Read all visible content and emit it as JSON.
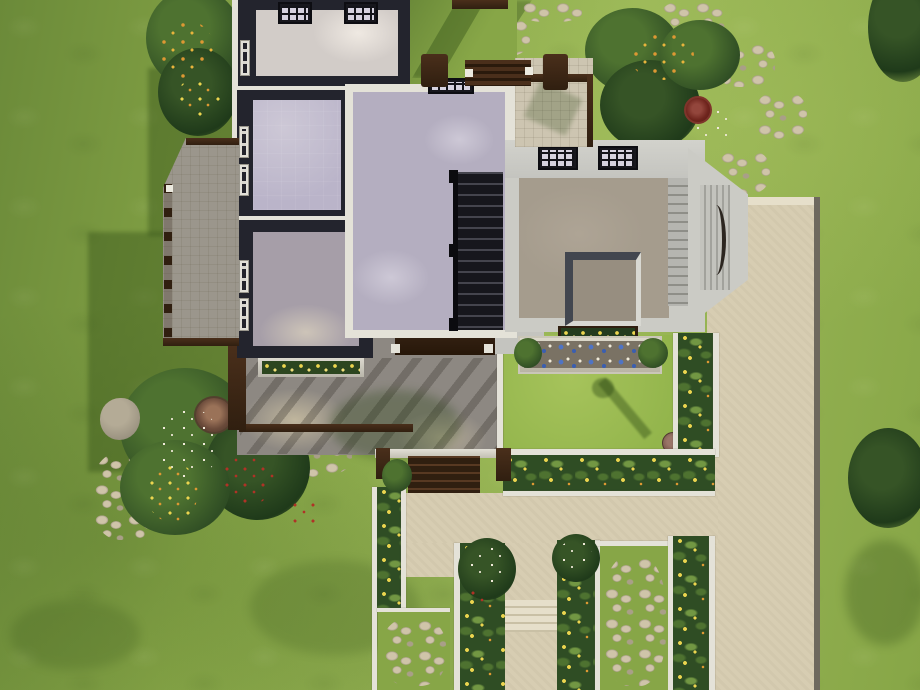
{
  "app": {
    "name": "life-sim-game",
    "view": "top-down aerial lot view"
  },
  "scene": {
    "setting": "suburban house lot with formal walled garden, concrete driveway and lawn",
    "house": {
      "skylight_count": 2,
      "east_wing_roof_windows": 2,
      "wall_windows": 6,
      "has_staircase": true,
      "has_open_shaft": true,
      "has_bay_window": true,
      "deck_count": 2,
      "porch_steps": true,
      "front_pergola": true
    },
    "garden": {
      "hedge_flower_color": "yellow",
      "planter_flower_colors": [
        "blue",
        "white",
        "yellow"
      ],
      "wildflower_colors": [
        "red",
        "orange",
        "white",
        "yellow"
      ],
      "stone_edged_walks": true,
      "stepping_stones": true,
      "path_steps": true,
      "birdbath": true,
      "boulder": true,
      "tree_trunk_visible": true
    }
  },
  "palette": {
    "grass-base": "#87a647",
    "grass-light": "#9cb958",
    "grass-dark": "#6b8a39",
    "lawn-green": "#93b54c",
    "lawn-light": "#a6c35b",
    "shadow-tint": "#24400f",
    "pave": "#d7cdb2",
    "pave-light": "#e6dfca",
    "curb": "#6e695e",
    "stone-light": "#cfc4a9",
    "stone-mid": "#a99f88",
    "white-trim": "#e4e2d8",
    "wall-light": "#cbcbc5",
    "roof-band": "#c4c4bf",
    "wall-dark": "#23242d",
    "floor-white": "#d2ccc8",
    "floor-lavender": "#b4aec0",
    "floor-lav-light": "#cdc8d6",
    "floor-tile": "#bab4c9",
    "floor-mauve": "#a69ea8",
    "floor-tan": "#a59c8d",
    "shaft-dark": "#42464f",
    "deck-floor": "#cdc5b1",
    "deck-gray": "#9b968c",
    "porch": "#8d8882",
    "porch-light": "#c9bea2",
    "wood-dark": "#301f10",
    "wood-mid": "#583922",
    "hedge-dark": "#2f4d24",
    "hedge-mid": "#4e7230",
    "hedge-light": "#729743",
    "flower-yellow": "#ecd54f",
    "flower-orange": "#dd9833",
    "flower-red": "#b03226",
    "flower-blue": "#4f74c4",
    "flower-white": "#f0ead9",
    "soil": "#7a7264",
    "glass-dark": "#17171d",
    "pane": "#d6d2df",
    "lamp-base": "#7d5a4e"
  }
}
